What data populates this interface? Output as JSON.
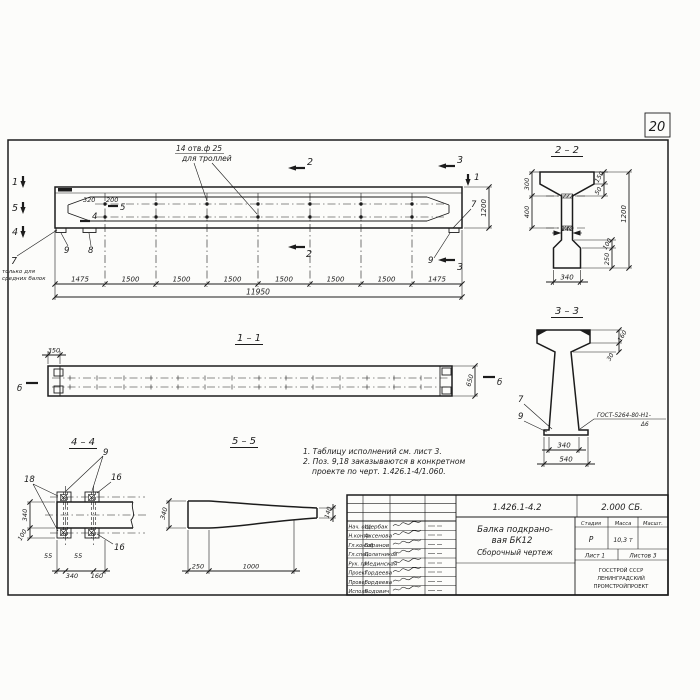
{
  "colors": {
    "paper": "#fcfcfa",
    "ink": "#1c1c1c"
  },
  "sheet": {
    "number": "20"
  },
  "main_view": {
    "holes_note": {
      "line1": "14 отв.ф 25",
      "line2": "для троллей"
    },
    "cut_marks": {
      "m1_left": "1",
      "m5_left": "5",
      "m4_left": "4",
      "m5_in": "5",
      "m4_in": "4",
      "m2_top": "2",
      "m2_bot": "2",
      "m3_top": "3",
      "m3_bot": "3",
      "m1_right": "1"
    },
    "labels": {
      "pos7": "7",
      "pos7_note1": "только для",
      "pos7_note2": "средних балок",
      "pos9": "9",
      "pos8": "8",
      "pos7_right": "7",
      "pos9_right": "9"
    },
    "dims": {
      "d320": "320",
      "d200": "200",
      "height": "1200",
      "total": "11950",
      "row": [
        "1475",
        "1500",
        "1500",
        "1500",
        "1500",
        "1500",
        "1500",
        "1475"
      ]
    }
  },
  "section_2_2": {
    "title": "2 – 2",
    "dims": {
      "d300": "300",
      "d400": "400",
      "d150": "150",
      "d50": "50",
      "d1200": "1200",
      "d100": "100",
      "d250": "250",
      "d140": "140",
      "d340": "340"
    }
  },
  "section_3_3": {
    "title": "3 – 3",
    "dims": {
      "d160": "160",
      "d30": "30",
      "d340": "340",
      "d540": "540"
    },
    "labels": {
      "pos7": "7",
      "pos9": "9"
    },
    "weld": {
      "line1": "ГОСТ-5264-80-Н1-",
      "line2": "Δ6"
    }
  },
  "section_1_1": {
    "title": "1 – 1",
    "dims": {
      "d350": "350",
      "d650": "650"
    },
    "marks": {
      "left": "б",
      "right": "б"
    }
  },
  "section_4_4": {
    "title": "4 – 4",
    "labels": {
      "pos9": "9",
      "pos18": "18",
      "pos16_top": "16",
      "pos16_bot": "16"
    },
    "dims": {
      "v340": "340",
      "v100": "100",
      "d55a": "55",
      "d55b": "55",
      "h340": "340",
      "h160": "160"
    }
  },
  "section_5_5": {
    "title": "5 – 5",
    "dims": {
      "d340": "340",
      "d140": "140",
      "d250": "250",
      "d1000": "1000"
    }
  },
  "notes": {
    "line1": "1. Таблицу исполнений см. лист 3.",
    "line2": "2. Поз. 9,18 заказываются в конкретном",
    "line3": "проекте по черт. 1.426.1-4/1.060."
  },
  "title_block": {
    "doc_number": "1.426.1-4.2",
    "doc_code": "2.000 СБ.",
    "title_line1": "Балка подкрано-",
    "title_line2": "вая БК12",
    "title_line3": "Сборочный чертеж",
    "stage_header": "Стадия",
    "mass_header": "Масса",
    "scale_header": "Масшт.",
    "stage": "Р",
    "mass": "10,3 т",
    "sheet_label": "Лист 1",
    "sheets_label": "Листов 3",
    "org_line1": "ГОССТРОЙ СССР",
    "org_line2": "ЛЕНИНГРАДСКИЙ",
    "org_line3": "ПРОМСТРОЙПРОЕКТ",
    "rows": [
      {
        "role": "Нач. отд",
        "name": "Щербак"
      },
      {
        "role": "Н.контр.",
        "name": "Аксенова"
      },
      {
        "role": "Гл.кон.об",
        "name": "Баранов"
      },
      {
        "role": "Гл.спец.",
        "name": "Полатников"
      },
      {
        "role": "Рук. гр.",
        "name": "Мединская"
      },
      {
        "role": "Проект.",
        "name": "Гордеева"
      },
      {
        "role": "Провер.",
        "name": "Гордеева"
      },
      {
        "role": "Исполн.",
        "name": "Бодович"
      }
    ]
  }
}
